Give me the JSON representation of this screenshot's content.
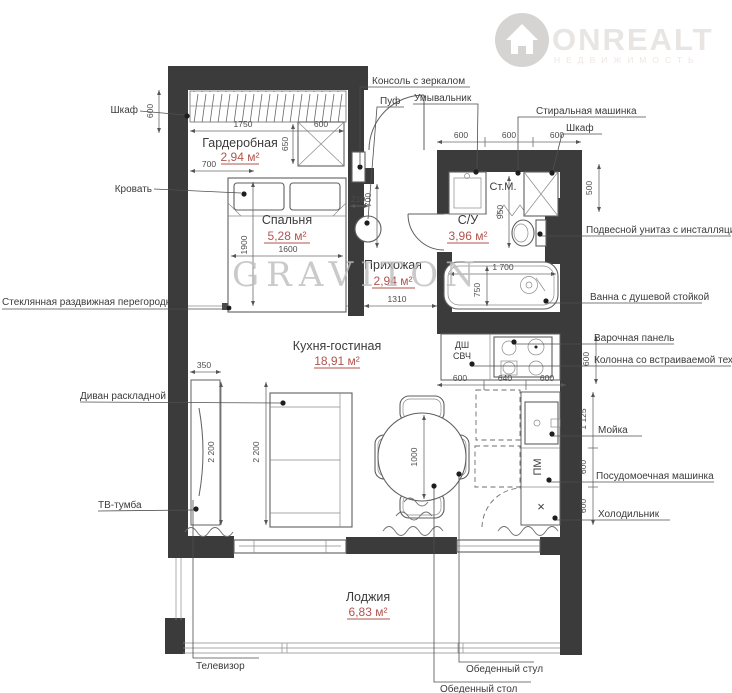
{
  "brand": {
    "logo": "ONREALT",
    "logo_sub": "НЕДВИЖИМОСТЬ",
    "watermark": "GRAVITON"
  },
  "rooms": {
    "wardrobe": {
      "name": "Гардеробная",
      "area": "2,94 м²"
    },
    "bedroom": {
      "name": "Спальня",
      "area": "5,28 м²"
    },
    "hallway": {
      "name": "Прихожая",
      "area": "2,94 м²"
    },
    "bathroom": {
      "name": "С/У",
      "area": "3,96 м²"
    },
    "kitchen_living": {
      "name": "Кухня-гостиная",
      "area": "18,91 м²"
    },
    "loggia": {
      "name": "Лоджия",
      "area": "6,83 м²"
    }
  },
  "callouts": {
    "closet_left": "Шкаф",
    "bed": "Кровать",
    "glass_partition": "Стеклянная раздвижная перегородка",
    "sofa": "Диван раскладной",
    "tv_stand": "ТВ-тумба",
    "console": "Консоль с зеркалом",
    "pouf": "Пуф",
    "washbasin": "Умывальник",
    "washing_machine": "Стиральная машинка",
    "closet_right": "Шкаф",
    "wall_hung_toilet": "Подвесной унитаз с инсталляцией",
    "bathtub": "Ванна с душевой стойкой",
    "hob": "Варочная панель",
    "column_appliances": "Колонна со встраиваемой техникой",
    "sink": "Мойка",
    "dishwasher": "Посудомоечная машинка",
    "fridge": "Холодильник",
    "tv": "Телевизор",
    "dining_chair": "Обеденный стул",
    "dining_table": "Обеденный стол"
  },
  "marks": {
    "washing_machine": "Ст.М.",
    "dishwasher": "ПМ",
    "oven": "ДШ",
    "microwave": "СВЧ",
    "fridge": "×"
  },
  "dims": {
    "wardrobe_side": "600",
    "wardrobe_width": "1750",
    "wardrobe_cab_width": "600",
    "wardrobe_cab_depth": "650",
    "bed_offset": "700",
    "bed_length": "1900",
    "bed_width": "1600",
    "pouf_offset": "210",
    "pouf_zone": "700",
    "san_top_1": "600",
    "san_top_2": "600",
    "san_top_3": "600",
    "shaft_height": "500",
    "wc_zone": "950",
    "bath_length": "1 700",
    "bath_width": "750",
    "hall_width": "1310",
    "counter_depth": "600",
    "counter_1": "600",
    "counter_2": "640",
    "counter_3": "600",
    "tv_depth": "350",
    "living_1": "2 200",
    "living_2": "2 200",
    "table_diameter": "1000",
    "sink_zone": "1 125",
    "dw_zone": "600",
    "fridge_zone": "600"
  },
  "colors": {
    "wall": "#3b3b3b",
    "area_text": "#b2544e",
    "label_text": "#3b3b3b",
    "watermark": "#bdbdbd",
    "logo": "#e8e5e2"
  }
}
